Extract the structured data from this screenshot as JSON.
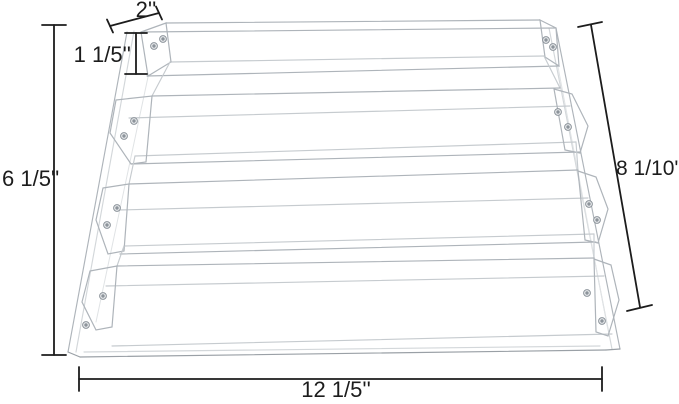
{
  "diagram": {
    "name": "4-tier clear acrylic display riser dimension diagram",
    "tier_count": 4,
    "dimensions": {
      "top_depth": "2''",
      "lip_height": "1 1/5''",
      "overall_height": "6 1/5''",
      "slant_depth": "8 1/10''",
      "overall_width": "12 1/5''"
    },
    "colors": {
      "dimension_line": "#1c1c1c",
      "edge": "#aeb4ba",
      "edge_light": "#d3d7da",
      "screw": "#8d949b",
      "screw_fill": "#e9ebed",
      "background": "#ffffff"
    }
  }
}
